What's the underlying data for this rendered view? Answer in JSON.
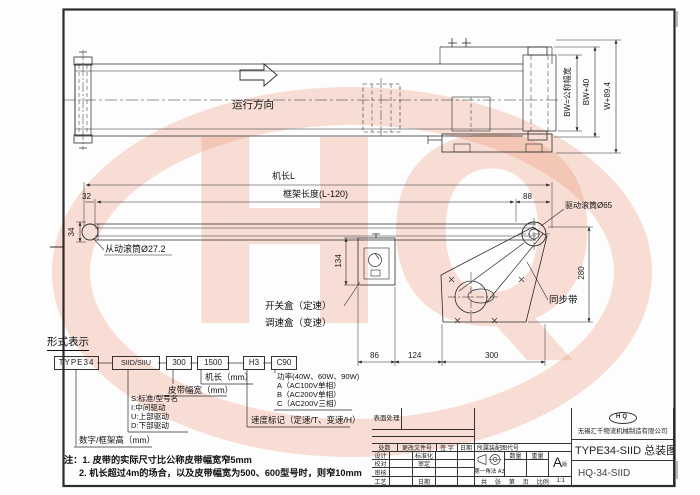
{
  "watermark": {
    "text": "HQ",
    "color": "#e9825f"
  },
  "drawing": {
    "top_view": {
      "direction_label": "运行方向",
      "dim_bw": "BW=公称幅宽",
      "dim_bw40": "BW+40",
      "dim_w894": "W+89.4"
    },
    "side_view": {
      "dim_machine_length": "机长L",
      "dim_frame_length": "框架长度(L-120)",
      "dim_32": "32",
      "dim_34": "34",
      "dim_88": "88",
      "dim_134": "134",
      "dim_280": "280",
      "dim_86": "86",
      "dim_124": "124",
      "dim_300": "300",
      "label_driven_roller": "从动滚筒Ø27.2",
      "label_drive_roller": "驱动滚筒Ø65",
      "label_switch_box": "开关盒（定速）",
      "label_speed_box": "调速盒（变速）",
      "label_sync_belt": "同步带"
    },
    "model_code": {
      "heading": "形式表示",
      "boxes": [
        "TYPE34",
        "SIID/SIIU",
        "300",
        "1500",
        "H3",
        "C90"
      ],
      "labels": {
        "frame_height": "数字/框架高（mm）",
        "drive_codes": [
          "S:标准/型号名",
          "I:中间驱动",
          "U:上部驱动",
          "D:下部驱动"
        ],
        "belt_width": "皮带幅宽（mm）",
        "machine_length": "机长（mm）",
        "speed_mark": "速度标记（定速/T、变速/H）",
        "power": [
          "功率(40W、60W、90W)",
          "A（AC100V单相）",
          "B（AC200V单相）",
          "C（AC200V三相）"
        ]
      }
    },
    "notes": {
      "line1": "注：1. 皮带的实际尺寸比公称皮带幅宽窄5mm",
      "line2": "2. 机长超过4m的场合，以及皮带幅宽为500、600型号时，则窄10mm"
    }
  },
  "title_block": {
    "surface_treatment": "表面处理",
    "header_row": [
      "处数",
      "更改文件号",
      "签 字",
      "日期"
    ],
    "rows": [
      {
        "left": "设计",
        "right": "标准化"
      },
      {
        "left": "校对",
        "right": "审定"
      },
      {
        "left": "审核",
        "right": ""
      },
      {
        "left": "工艺",
        "right": "日期"
      }
    ],
    "assembly_code_label": "所属装配图代号",
    "projection_label": "第一角法",
    "paper_size": "A3",
    "qty_label": "数量",
    "weight_label": "重量",
    "version_letter": "A",
    "version_label": "版",
    "sheet_cells": [
      "共",
      "张",
      "第",
      "页",
      "比例",
      "1:1"
    ],
    "logo_text": "HQ",
    "company": "无锡汇千物流机械制造有限公司",
    "drawing_title": "TYPE34-SIID 总装图",
    "drawing_number": "HQ-34-SIID"
  }
}
